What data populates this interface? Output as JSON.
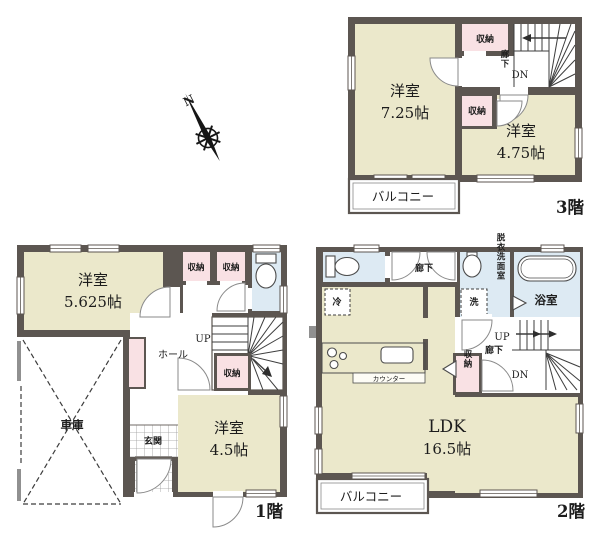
{
  "colors": {
    "wall": "#5c5651",
    "room_beige": "#ebe8cb",
    "closet_pink": "#f9e1e4",
    "wet_area_blue": "#ddeaf3",
    "balcony_white": "#ffffff"
  },
  "compass": {
    "north_label": "N"
  },
  "floors": {
    "f3": {
      "floor_label": "3階",
      "room1_name": "洋室",
      "room1_size": "7.25帖",
      "room2_name": "洋室",
      "room2_size": "4.75帖",
      "closet_top": "収納",
      "closet_mid": "収納",
      "hallway": "廊下",
      "down": "DN",
      "balcony": "バルコニー"
    },
    "f1": {
      "floor_label": "1階",
      "room1_name": "洋室",
      "room1_size": "5.625帖",
      "room2_name": "洋室",
      "room2_size": "4.5帖",
      "closet_a": "収納",
      "closet_b": "収納",
      "closet_c": "収納",
      "hall": "ホール",
      "up": "UP",
      "entrance": "玄関",
      "garage": "車庫"
    },
    "f2": {
      "floor_label": "2階",
      "ldk_name": "LDK",
      "ldk_size": "16.5帖",
      "hallway_top": "廊下",
      "hallway_mid": "廊下",
      "up": "UP",
      "down": "DN",
      "closet": "収納",
      "washroom": "脱衣洗面室",
      "bathroom": "浴室",
      "washer": "洗",
      "fridge": "冷",
      "counter": "カウンター",
      "balcony": "バルコニー"
    }
  }
}
